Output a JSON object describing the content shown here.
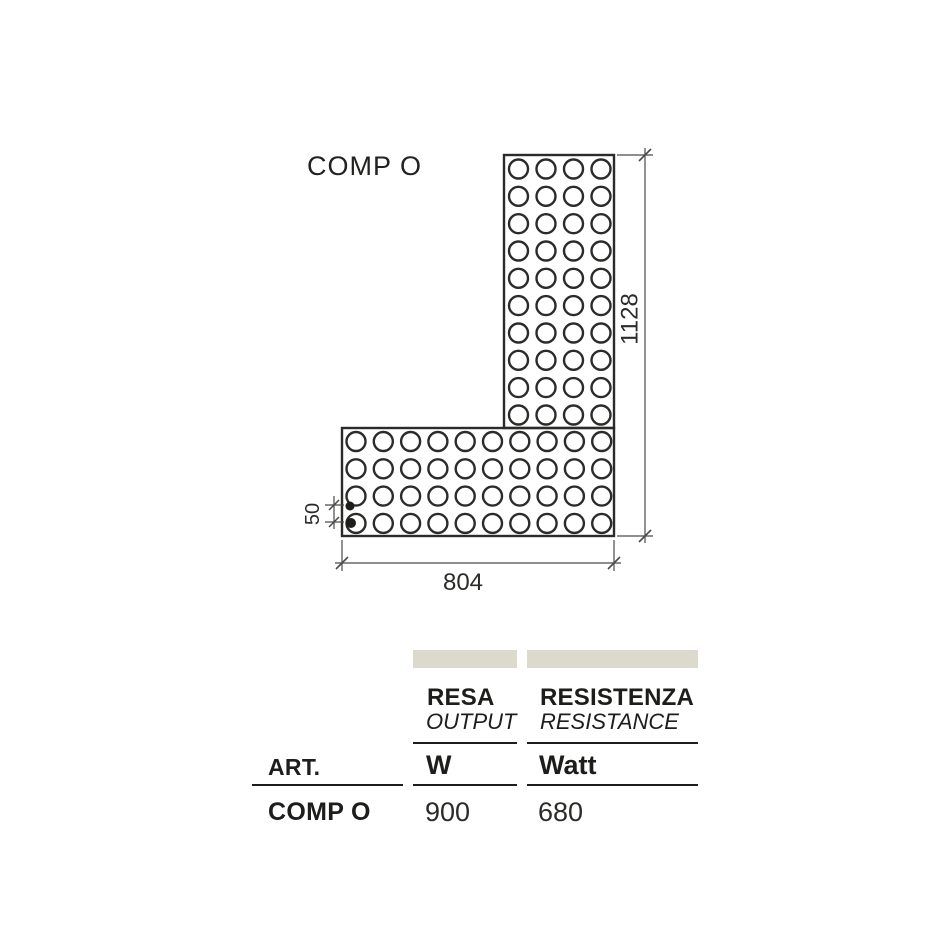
{
  "diagram": {
    "label": "COMP O",
    "dimensions": {
      "width": "804",
      "height": "1128",
      "connection_spacing": "50"
    },
    "hole_grid": {
      "vertical_panel": {
        "cols": 4,
        "rows": 10
      },
      "horizontal_panel": {
        "cols": 10,
        "rows": 4
      }
    }
  },
  "table": {
    "art": {
      "header": "ART."
    },
    "resa": {
      "header_it": "RESA",
      "header_en": "OUTPUT",
      "unit": "W"
    },
    "resistenza": {
      "header_it": "RESISTENZA",
      "header_en": "RESISTANCE",
      "unit": "Watt"
    },
    "row": {
      "art": "COMP O",
      "resa": "900",
      "resistenza": "680"
    }
  },
  "colors": {
    "line": "#2b2b29",
    "dimension_line": "#4a4a48",
    "swatch": "#dcdacd",
    "background": "#ffffff"
  }
}
